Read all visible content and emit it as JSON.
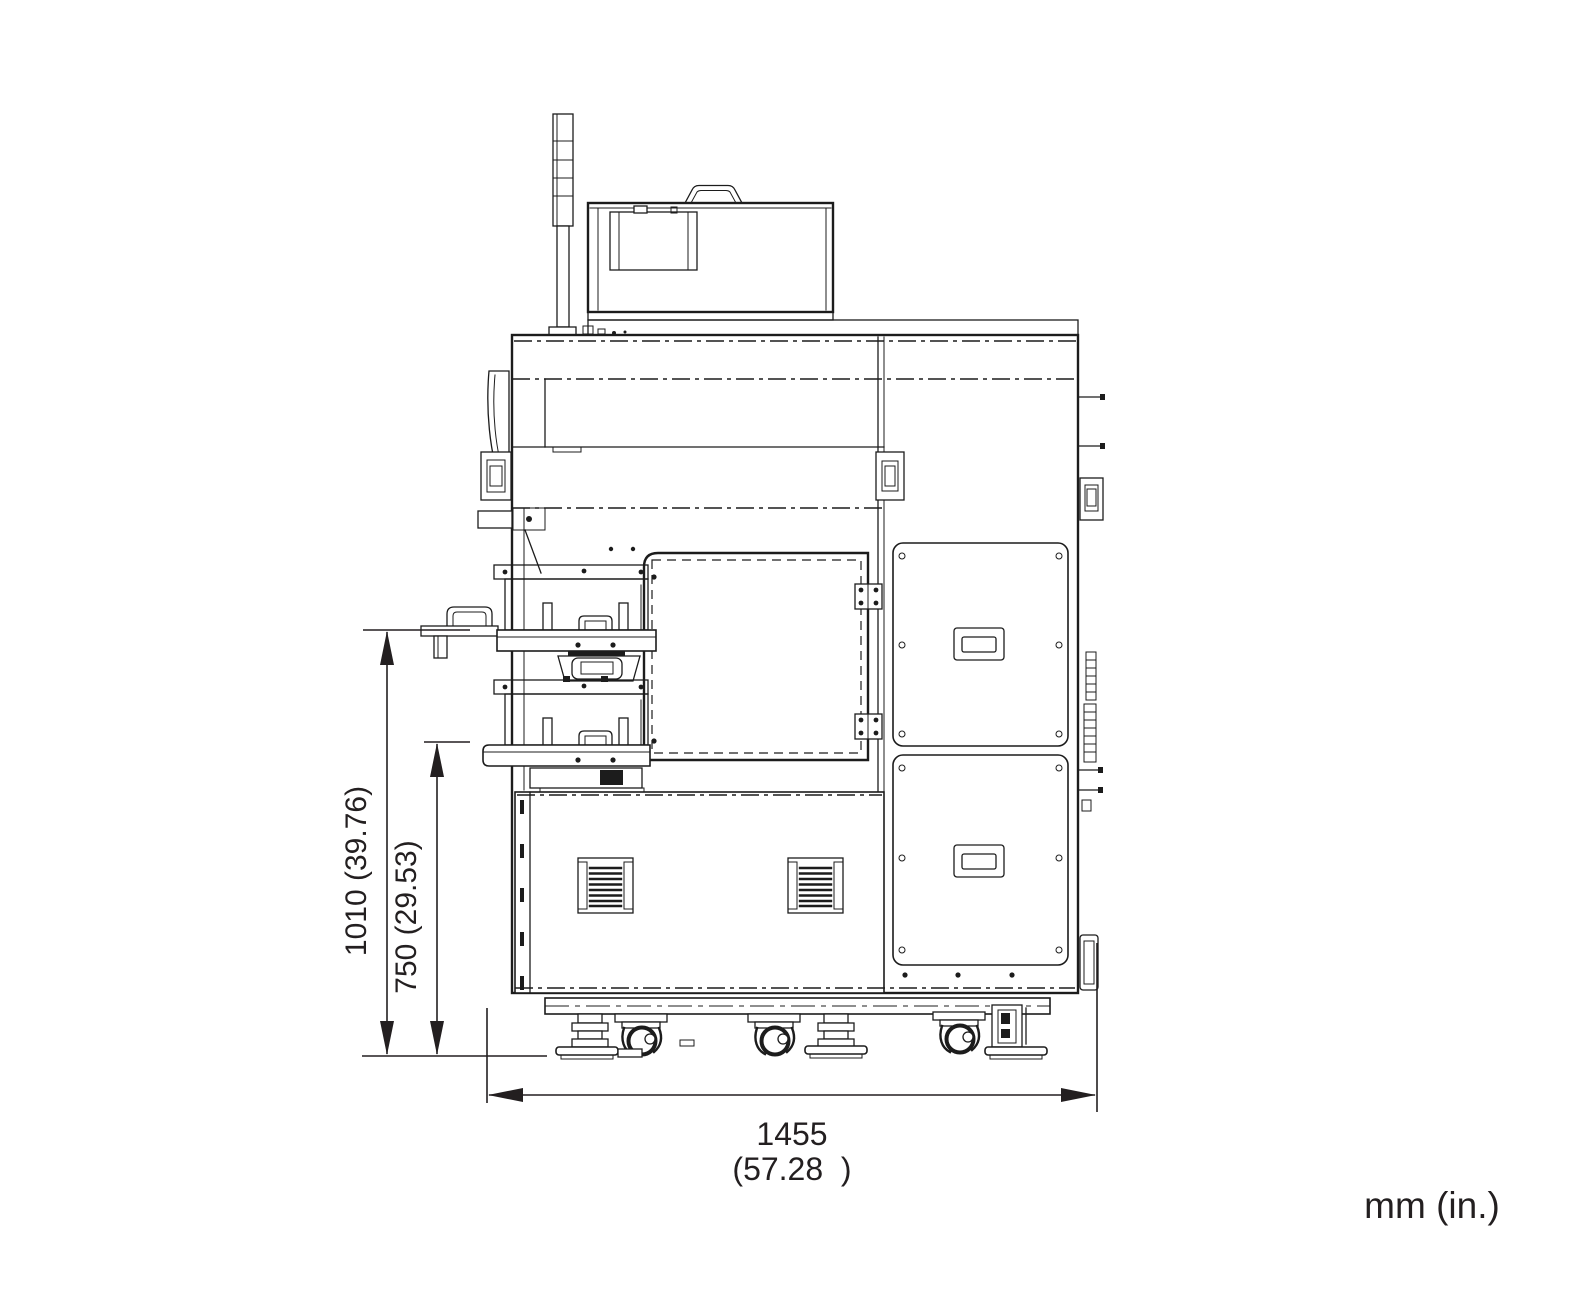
{
  "dims": {
    "h1": "1010 (39.76)",
    "h2": "750 (29.53)",
    "w_mm": "1455",
    "w_in": "(57.28  )",
    "units": "mm (in.)"
  }
}
